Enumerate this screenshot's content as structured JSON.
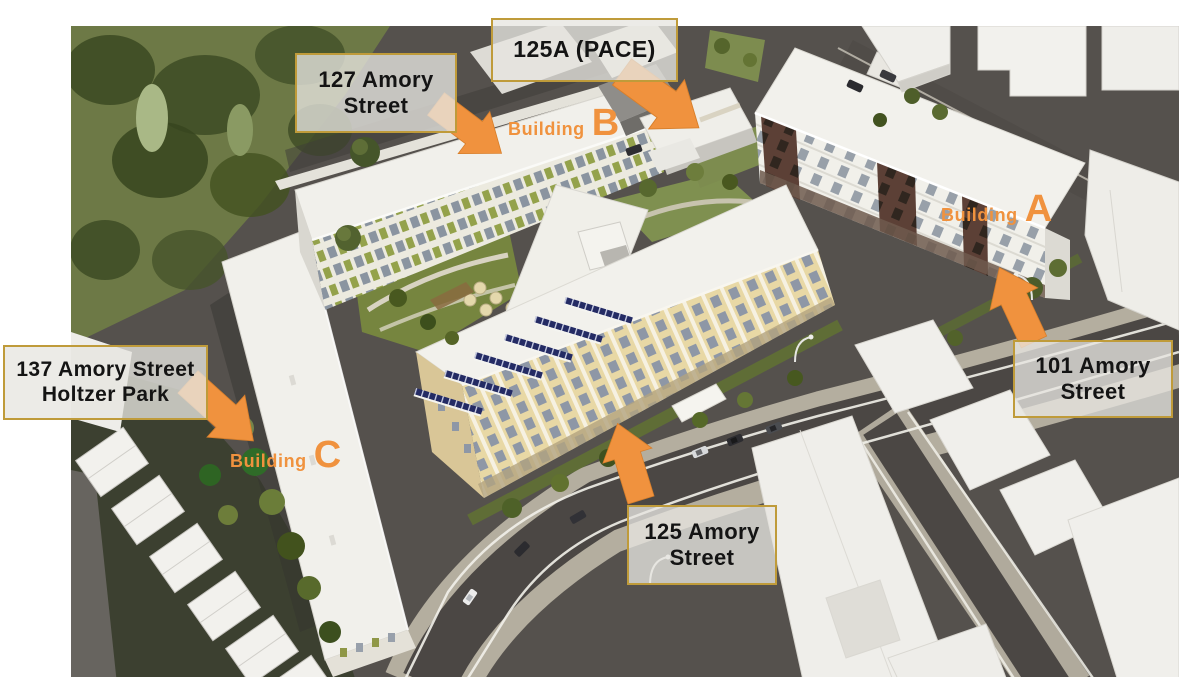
{
  "annotations": {
    "labels": [
      {
        "id": "125a",
        "line1": "125A (PACE)",
        "line2": ""
      },
      {
        "id": "127",
        "line1": "127 Amory",
        "line2": "Street"
      },
      {
        "id": "101",
        "line1": "101 Amory",
        "line2": "Street"
      },
      {
        "id": "137",
        "line1": "137 Amory Street",
        "line2": "Holtzer Park"
      },
      {
        "id": "125",
        "line1": "125 Amory",
        "line2": "Street"
      }
    ],
    "building_tags": [
      {
        "word": "Building",
        "letter": "B"
      },
      {
        "word": "Building",
        "letter": "A"
      },
      {
        "word": "Building",
        "letter": "C"
      }
    ]
  },
  "colors": {
    "accent_orange": "#F0923E",
    "label_border": "#BF9B3A",
    "label_background": "#E8E7E1",
    "solar_panel": "#242B64"
  }
}
